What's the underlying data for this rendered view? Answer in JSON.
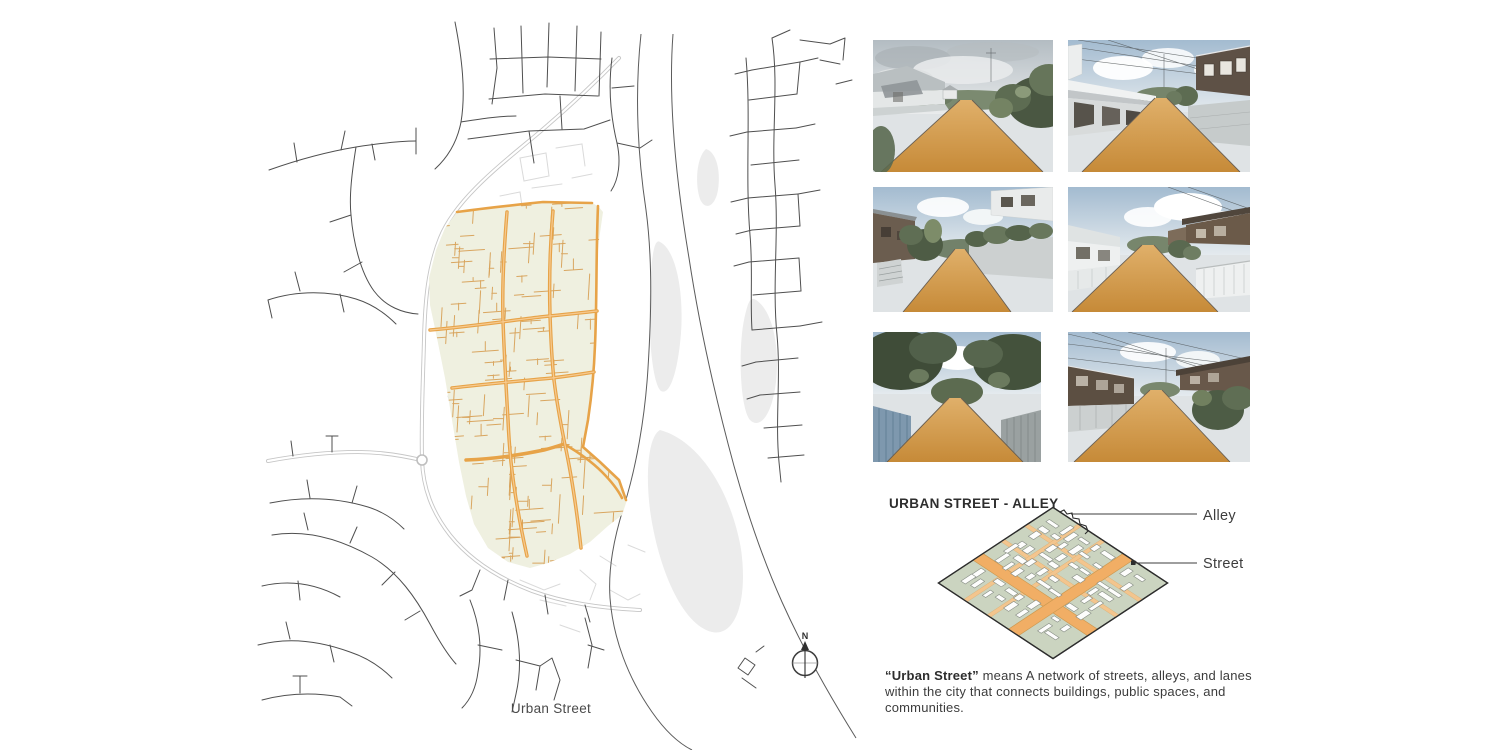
{
  "page": {
    "background": "#ffffff"
  },
  "map": {
    "caption": "Urban Street",
    "compass": "N",
    "colors": {
      "district_fill": "#eff0e0",
      "street_main_orange": "#e7a348",
      "street_alley_orange": "#d7a158",
      "road_network": "#4f4f4f",
      "highway_casing": "#c6c6c6",
      "river_line": "#5b5b5b",
      "island_fill": "#ececec"
    }
  },
  "photo_grid": {
    "photos": [
      {
        "name": "alley-photo-1",
        "description": "Alley with orange-highlighted dirt road between low houses and dense greenery under an overcast sky"
      },
      {
        "name": "alley-photo-2",
        "description": "Alley with orange-highlighted dirt road between a white carport building and a dark wooden house"
      },
      {
        "name": "alley-photo-3",
        "description": "Narrow alley with orange-highlighted dirt road between a wooden house with stairs and a walled garden"
      },
      {
        "name": "alley-photo-4",
        "description": "Alley with orange-highlighted dirt road passing white fences and a house with a white balustrade"
      },
      {
        "name": "alley-photo-5",
        "description": "Alley with orange-highlighted dirt road between a blue fence and overgrown trees"
      },
      {
        "name": "alley-photo-6",
        "description": "Alley with orange-highlighted dirt road between dark wooden houses under overhead power lines"
      }
    ]
  },
  "alley_section": {
    "heading": "URBAN STREET - ALLEY",
    "labels": {
      "alley": "Alley",
      "street": "Street"
    },
    "caption_bold": "“Urban Street”",
    "caption_rest": " means A network of streets, alleys, and lanes within the city that connects buildings, public spaces, and communities.",
    "colors": {
      "block_green": "#cbd4c0",
      "street_orange": "#f1ae65",
      "alley_orange": "#f3c58e",
      "building_white": "#fdfdfc"
    }
  }
}
